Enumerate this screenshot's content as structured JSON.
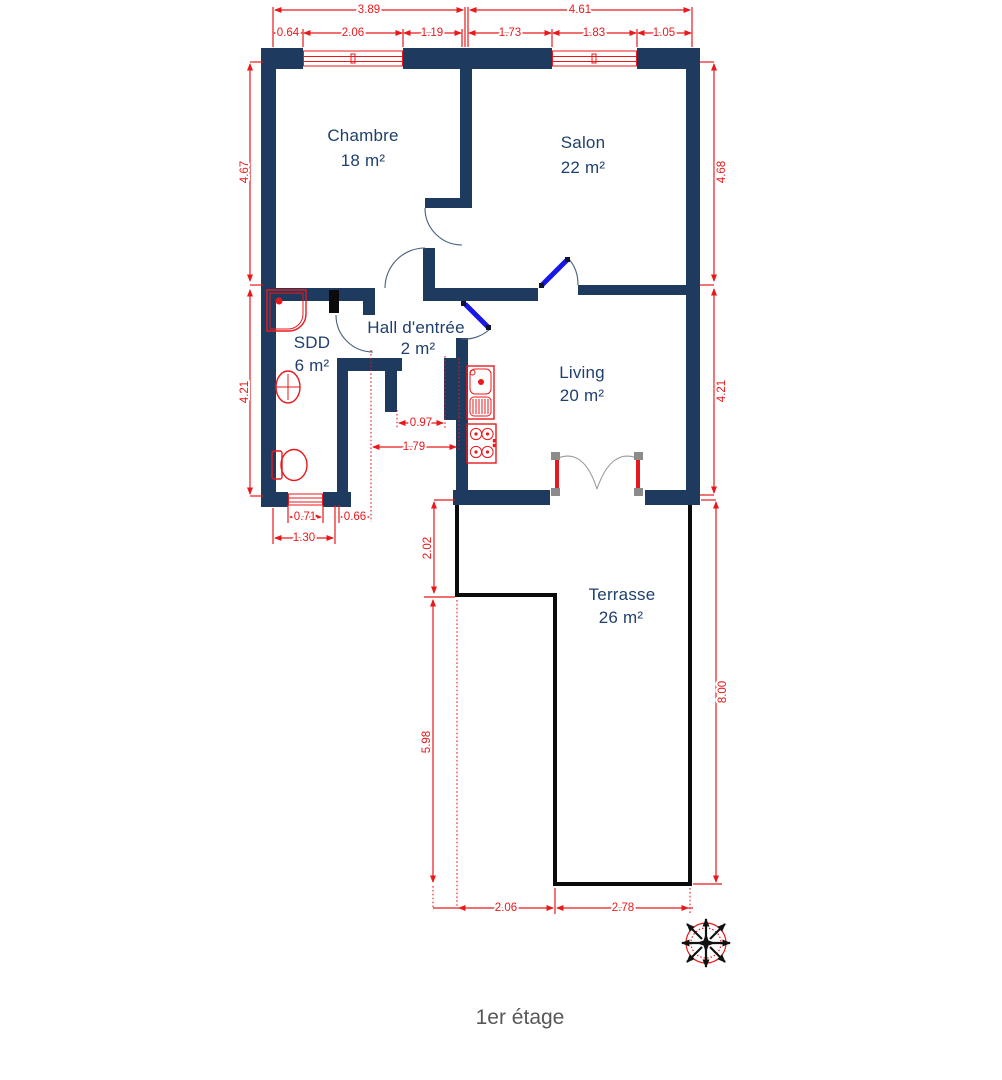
{
  "caption": "1er étage",
  "colors": {
    "wall": "#1e3a5e",
    "black": "#0b0b0b",
    "red": "#e8191c",
    "blue": "#1717e8",
    "grey_post": "#8b8b8b",
    "caption": "#58585a",
    "label": "#1f3f6e"
  },
  "rooms": {
    "chambre": {
      "name": "Chambre",
      "area": "18 m²"
    },
    "salon": {
      "name": "Salon",
      "area": "22 m²"
    },
    "sdd": {
      "name": "SDD",
      "area": "6 m²"
    },
    "hall": {
      "name": "Hall d'entrée",
      "area": "2 m²"
    },
    "living": {
      "name": "Living",
      "area": "20 m²"
    },
    "terrasse": {
      "name": "Terrasse",
      "area": "26 m²"
    }
  },
  "dims": {
    "top_left_overall": "3.89",
    "top_right_overall": "4.61",
    "top_d1": "0.64",
    "top_d2": "2.06",
    "top_d3": "1.19",
    "top_d4": "1.73",
    "top_d5": "1.83",
    "top_d6": "1.05",
    "left_upper": "4.67",
    "left_lower": "4.21",
    "right_upper": "4.68",
    "right_lower": "4.21",
    "right_terrace": "8.00",
    "hall_opening": "0.97",
    "hall_width": "1.79",
    "sdd_window": "0.71",
    "sdd_opening": "0.66",
    "sdd_width": "1.30",
    "terrace_step": "2.02",
    "terrace_left": "5.98",
    "terrace_bottom_left": "2.06",
    "terrace_bottom_right": "2.78"
  }
}
